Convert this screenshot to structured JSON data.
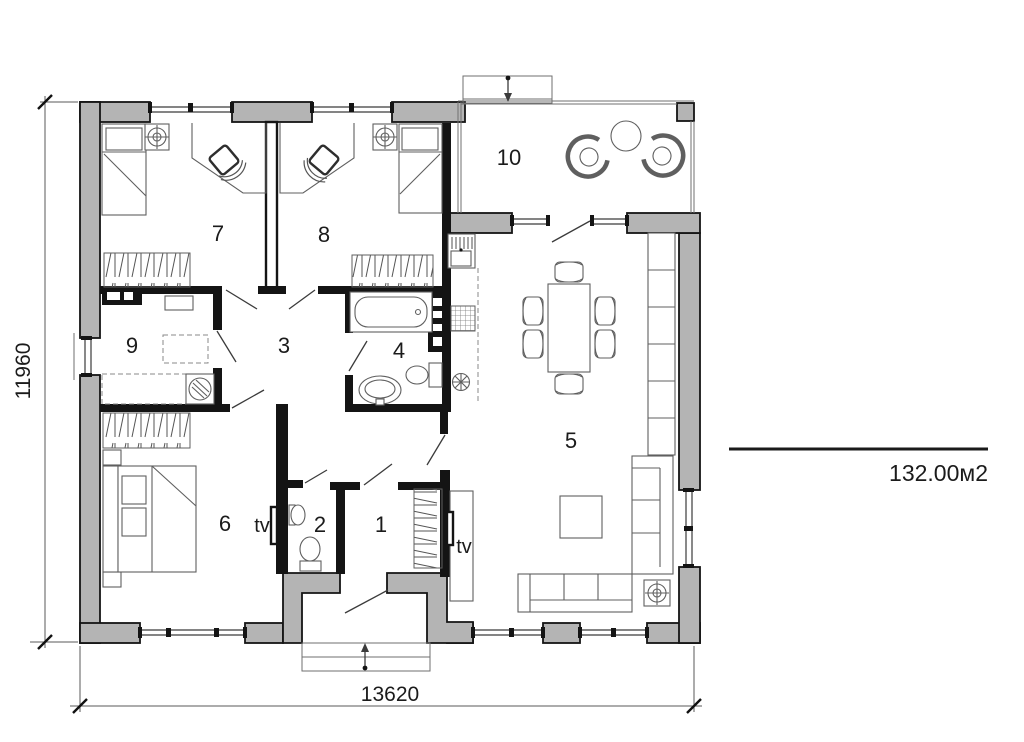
{
  "plan": {
    "labels": {
      "room1": "1",
      "room2": "2",
      "room3": "3",
      "room4": "4",
      "room5": "5",
      "room6": "6",
      "room7": "7",
      "room8": "8",
      "room9": "9",
      "room10": "10",
      "tv_bedroom": "tv",
      "tv_living": "tv"
    },
    "dims": {
      "width": "13620",
      "height": "11960"
    },
    "area_text": "132.00м2",
    "colors": {
      "wall_fill": "#b4b4b4",
      "wall_line": "#141414",
      "furniture_line": "#5f5f5f",
      "background": "#ffffff"
    }
  }
}
